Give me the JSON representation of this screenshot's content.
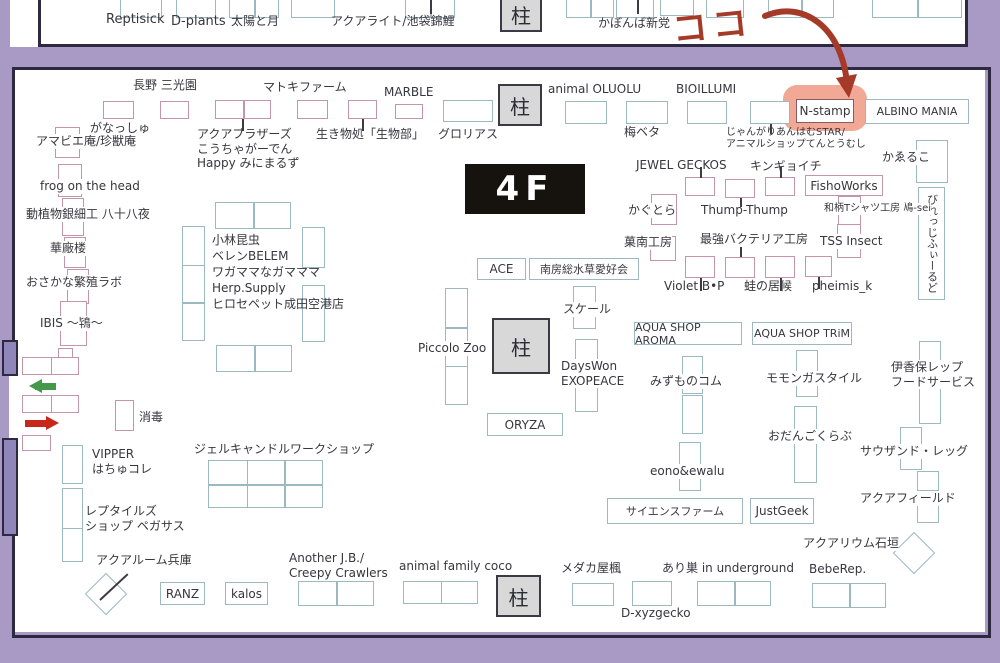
{
  "annotation": {
    "text": "ココ",
    "color": "#a63a28"
  },
  "floor": {
    "label": "4F"
  },
  "pillar_label": "柱",
  "colors": {
    "bg": "#a89ac5",
    "wall": "#9186b9",
    "border": "#2c2940",
    "pink": "#c494a8",
    "teal": "#9cb9c2",
    "nstamp_border": "#8a5a66",
    "highlight": "#ef9a82",
    "green_arrow": "#44984a",
    "red_arrow": "#c8271b",
    "pillar_fill": "#d8d8d8"
  },
  "top_strip": {
    "labels": [
      {
        "t": "Reptisick",
        "x": 96,
        "y": 12,
        "s": 13
      },
      {
        "t": "D-plants",
        "x": 161,
        "y": 14,
        "s": 13
      },
      {
        "t": "太陽と月",
        "x": 221,
        "y": 14
      },
      {
        "t": "アクアライト/池袋錦鯉",
        "x": 321,
        "y": 14
      },
      {
        "t": "かぼんば新党",
        "x": 588,
        "y": 16
      }
    ],
    "boxes": [
      {
        "x": 110,
        "y": -10,
        "w": 42,
        "h": 28
      },
      {
        "x": 166,
        "y": -10,
        "w": 40,
        "h": 28
      },
      {
        "x": 219,
        "y": -10,
        "w": 50,
        "h": 28,
        "n": 2
      },
      {
        "x": 281,
        "y": -10,
        "w": 44,
        "h": 28
      },
      {
        "x": 395,
        "y": -10,
        "w": 50,
        "h": 28,
        "n": 2
      },
      {
        "x": 556,
        "y": -10,
        "w": 48,
        "h": 28,
        "n": 2
      },
      {
        "x": 606,
        "y": -10,
        "w": 38,
        "h": 28
      },
      {
        "x": 650,
        "y": -8,
        "w": 34,
        "h": 24
      },
      {
        "x": 696,
        "y": -10,
        "w": 38,
        "h": 28
      },
      {
        "x": 758,
        "y": -10,
        "w": 66,
        "h": 28,
        "n": 2
      },
      {
        "x": 862,
        "y": -10,
        "w": 90,
        "h": 28,
        "n": 2
      }
    ],
    "ticks": [
      [
        420,
        0,
        14
      ],
      [
        627,
        0,
        14
      ]
    ],
    "pillar": {
      "x": 490,
      "y": -4,
      "w": 42,
      "h": 36
    }
  },
  "map": {
    "labels": [
      {
        "t": "長野 三光園",
        "x": 133,
        "y": 78
      },
      {
        "t": "マトキファーム",
        "x": 263,
        "y": 80
      },
      {
        "t": "MARBLE",
        "x": 384,
        "y": 85
      },
      {
        "t": "animal OLUOLU",
        "x": 548,
        "y": 82
      },
      {
        "t": "BIOILLUMI",
        "x": 676,
        "y": 82
      },
      {
        "t": "がなっしゅ",
        "x": 90,
        "y": 121
      },
      {
        "t": "アマビエ庵/珍獣庵",
        "x": 36,
        "y": 134,
        "bg": true
      },
      {
        "t": "アクアブラザーズ\nこうちゃがーでん\nHappy みにまるず",
        "x": 197,
        "y": 127
      },
      {
        "t": "生き物処「生物部」",
        "x": 316,
        "y": 127
      },
      {
        "t": "グロリアス",
        "x": 438,
        "y": 127
      },
      {
        "t": "梅ベタ",
        "x": 624,
        "y": 125
      },
      {
        "t": "じゃんがりあんはむSTAR/\nアニマルショップてんとうむし",
        "x": 726,
        "y": 127,
        "s": 10
      },
      {
        "t": "かゑるこ",
        "x": 882,
        "y": 150,
        "bg": true
      },
      {
        "t": "JEWEL GECKOS",
        "x": 636,
        "y": 158
      },
      {
        "t": "キンギョイチ",
        "x": 750,
        "y": 159
      },
      {
        "t": "かぐとら",
        "x": 628,
        "y": 203,
        "bg": true
      },
      {
        "t": "Thump-Thump",
        "x": 701,
        "y": 203
      },
      {
        "t": "和柄Tシャツ工房 鳰-sei",
        "x": 824,
        "y": 203,
        "s": 10,
        "bg": true
      },
      {
        "t": "菓南工房",
        "x": 624,
        "y": 235,
        "bg": true
      },
      {
        "t": "最強バクテリア工房",
        "x": 700,
        "y": 232
      },
      {
        "t": "TSS Insect",
        "x": 820,
        "y": 234,
        "bg": true
      },
      {
        "t": "frog on the head",
        "x": 40,
        "y": 179,
        "bg": true
      },
      {
        "t": "動植物銀細工 八十八夜",
        "x": 26,
        "y": 207,
        "bg": true
      },
      {
        "t": "華廠楼",
        "x": 50,
        "y": 241,
        "bg": true
      },
      {
        "t": "おさかな繁殖ラボ",
        "x": 26,
        "y": 275,
        "bg": true
      },
      {
        "t": "IBIS ～鴇～",
        "x": 40,
        "y": 316,
        "bg": true
      },
      {
        "t": "小林昆虫",
        "x": 212,
        "y": 233
      },
      {
        "t": "ベレンBELEM",
        "x": 212,
        "y": 249
      },
      {
        "t": "ワガママなガマママ",
        "x": 212,
        "y": 265
      },
      {
        "t": "Herp.Supply",
        "x": 212,
        "y": 281
      },
      {
        "t": "ヒロセペット成田空港店",
        "x": 212,
        "y": 297
      },
      {
        "t": "Violet B•P",
        "x": 664,
        "y": 279
      },
      {
        "t": "蛙の居候",
        "x": 744,
        "y": 279
      },
      {
        "t": "pheimis_k",
        "x": 812,
        "y": 279
      },
      {
        "t": "スケール",
        "x": 563,
        "y": 302,
        "bg": true
      },
      {
        "t": "Piccolo Zoo",
        "x": 418,
        "y": 341,
        "bg": true
      },
      {
        "t": "DaysWon\nEXOPEACE",
        "x": 561,
        "y": 359,
        "bg": true
      },
      {
        "t": "みずものコム",
        "x": 650,
        "y": 374,
        "bg": true
      },
      {
        "t": "モモンガスタイル",
        "x": 766,
        "y": 371,
        "bg": true
      },
      {
        "t": "伊香保レップ\nフードサービス",
        "x": 891,
        "y": 360,
        "bg": true
      },
      {
        "t": "おだんごくらぶ",
        "x": 768,
        "y": 429,
        "bg": true
      },
      {
        "t": "サウザンド・レッグ",
        "x": 860,
        "y": 444,
        "bg": true
      },
      {
        "t": "eono&ewalu",
        "x": 650,
        "y": 464,
        "bg": true
      },
      {
        "t": "アクアフィールド",
        "x": 860,
        "y": 491,
        "bg": true
      },
      {
        "t": "アクアリウム石垣",
        "x": 803,
        "y": 536,
        "bg": true
      },
      {
        "t": "消毒",
        "x": 139,
        "y": 410
      },
      {
        "t": "VIPPER\nはちゅコレ",
        "x": 92,
        "y": 447
      },
      {
        "t": "レプタイルズ\nショップ ペガサス",
        "x": 85,
        "y": 504
      },
      {
        "t": "アクアルーム兵庫",
        "x": 96,
        "y": 553
      },
      {
        "t": "ジェルキャンドルワークショップ",
        "x": 194,
        "y": 442
      },
      {
        "t": "Another J.B./\nCreepy Crawlers",
        "x": 289,
        "y": 551
      },
      {
        "t": "animal family coco",
        "x": 399,
        "y": 559
      },
      {
        "t": "メダカ屋楓",
        "x": 561,
        "y": 561
      },
      {
        "t": "あり巣 in underground",
        "x": 662,
        "y": 561
      },
      {
        "t": "BebeRep.",
        "x": 809,
        "y": 562
      },
      {
        "t": "D-xyzgecko",
        "x": 621,
        "y": 606
      }
    ],
    "boxes": [
      {
        "x": 103,
        "y": 101,
        "w": 31,
        "h": 18
      },
      {
        "x": 160,
        "y": 101,
        "w": 29,
        "h": 18
      },
      {
        "x": 215,
        "y": 100,
        "w": 56,
        "h": 19,
        "n": 2
      },
      {
        "x": 297,
        "y": 100,
        "w": 31,
        "h": 19
      },
      {
        "x": 348,
        "y": 100,
        "w": 29,
        "h": 19
      },
      {
        "x": 395,
        "y": 104,
        "w": 28,
        "h": 15
      },
      {
        "x": 55,
        "y": 127,
        "w": 25,
        "h": 31
      },
      {
        "x": 58,
        "y": 164,
        "w": 24,
        "h": 33
      },
      {
        "x": 62,
        "y": 198,
        "w": 22,
        "h": 38
      },
      {
        "x": 64,
        "y": 237,
        "w": 22,
        "h": 31
      },
      {
        "x": 67,
        "y": 269,
        "w": 22,
        "h": 35
      },
      {
        "x": 60,
        "y": 301,
        "w": 27,
        "h": 45
      },
      {
        "x": 58,
        "y": 348,
        "w": 15,
        "h": 14
      },
      {
        "x": 22,
        "y": 357,
        "w": 57,
        "h": 18,
        "n": 2
      },
      {
        "x": 22,
        "y": 395,
        "w": 57,
        "h": 18,
        "n": 2
      },
      {
        "x": 22,
        "y": 435,
        "w": 29,
        "h": 16
      },
      {
        "x": 115,
        "y": 400,
        "w": 19,
        "h": 31
      },
      {
        "x": 651,
        "y": 194,
        "w": 26,
        "h": 31
      },
      {
        "x": 650,
        "y": 236,
        "w": 26,
        "h": 25
      },
      {
        "x": 838,
        "y": 196,
        "w": 23,
        "h": 29
      },
      {
        "x": 837,
        "y": 224,
        "w": 24,
        "h": 34
      },
      {
        "x": 685,
        "y": 177,
        "w": 30,
        "h": 19
      },
      {
        "x": 725,
        "y": 179,
        "w": 30,
        "h": 19
      },
      {
        "x": 765,
        "y": 177,
        "w": 30,
        "h": 19
      },
      {
        "x": 685,
        "y": 256,
        "w": 30,
        "h": 22
      },
      {
        "x": 725,
        "y": 257,
        "w": 30,
        "h": 21
      },
      {
        "x": 765,
        "y": 256,
        "w": 30,
        "h": 22
      },
      {
        "x": 805,
        "y": 256,
        "w": 27,
        "h": 21
      },
      {
        "x": 805,
        "y": 175,
        "w": 78,
        "h": 21,
        "txt": "FishoWorks"
      },
      {
        "x": 796,
        "y": 99,
        "w": 58,
        "h": 24,
        "c": "n",
        "txt": "N-stamp"
      },
      {
        "x": 443,
        "y": 100,
        "w": 50,
        "h": 22,
        "c": "t"
      },
      {
        "x": 565,
        "y": 101,
        "w": 42,
        "h": 23,
        "c": "t"
      },
      {
        "x": 626,
        "y": 101,
        "w": 42,
        "h": 23,
        "c": "t"
      },
      {
        "x": 687,
        "y": 101,
        "w": 40,
        "h": 23,
        "c": "t"
      },
      {
        "x": 750,
        "y": 101,
        "w": 40,
        "h": 23,
        "c": "t"
      },
      {
        "x": 865,
        "y": 99,
        "w": 104,
        "h": 25,
        "c": "t",
        "txt": "ALBINO MANIA",
        "s": 11
      },
      {
        "x": 916,
        "y": 140,
        "w": 32,
        "h": 43,
        "c": "t"
      },
      {
        "x": 918,
        "y": 187,
        "w": 27,
        "h": 113,
        "c": "t",
        "vt": "びれっじふぃーるど"
      },
      {
        "x": 215,
        "y": 202,
        "w": 76,
        "h": 27,
        "c": "t",
        "n": 2
      },
      {
        "x": 182,
        "y": 226,
        "w": 23,
        "h": 115,
        "c": "t",
        "n": 3,
        "d": "v"
      },
      {
        "x": 302,
        "y": 227,
        "w": 23,
        "h": 41,
        "c": "t"
      },
      {
        "x": 302,
        "y": 285,
        "w": 23,
        "h": 57,
        "c": "t"
      },
      {
        "x": 216,
        "y": 345,
        "w": 76,
        "h": 27,
        "c": "t",
        "n": 2
      },
      {
        "x": 477,
        "y": 258,
        "w": 49,
        "h": 22,
        "c": "t",
        "txt": "ACE"
      },
      {
        "x": 529,
        "y": 258,
        "w": 110,
        "h": 22,
        "c": "t",
        "txt": "南房総水草愛好会",
        "s": 11
      },
      {
        "x": 573,
        "y": 286,
        "w": 23,
        "h": 43,
        "c": "t"
      },
      {
        "x": 575,
        "y": 339,
        "w": 23,
        "h": 73,
        "c": "t"
      },
      {
        "x": 445,
        "y": 288,
        "w": 23,
        "h": 117,
        "c": "t",
        "n": 3,
        "d": "v"
      },
      {
        "x": 487,
        "y": 413,
        "w": 76,
        "h": 23,
        "c": "t",
        "txt": "ORYZA"
      },
      {
        "x": 634,
        "y": 322,
        "w": 108,
        "h": 23,
        "c": "t",
        "txt": "AQUA SHOP AROMA",
        "s": 11
      },
      {
        "x": 752,
        "y": 322,
        "w": 100,
        "h": 23,
        "c": "t",
        "txt": "AQUA SHOP TRiM",
        "s": 11
      },
      {
        "x": 682,
        "y": 356,
        "w": 21,
        "h": 38,
        "c": "t"
      },
      {
        "x": 682,
        "y": 395,
        "w": 21,
        "h": 39,
        "c": "t"
      },
      {
        "x": 796,
        "y": 350,
        "w": 22,
        "h": 47,
        "c": "t"
      },
      {
        "x": 919,
        "y": 341,
        "w": 22,
        "h": 83,
        "c": "t"
      },
      {
        "x": 794,
        "y": 406,
        "w": 23,
        "h": 77,
        "c": "t"
      },
      {
        "x": 900,
        "y": 427,
        "w": 22,
        "h": 43,
        "c": "t"
      },
      {
        "x": 679,
        "y": 442,
        "w": 22,
        "h": 49,
        "c": "t"
      },
      {
        "x": 917,
        "y": 471,
        "w": 22,
        "h": 20,
        "c": "t"
      },
      {
        "x": 917,
        "y": 504,
        "w": 22,
        "h": 19,
        "c": "t"
      },
      {
        "x": 62,
        "y": 445,
        "w": 21,
        "h": 39,
        "c": "t"
      },
      {
        "x": 62,
        "y": 488,
        "w": 21,
        "h": 41,
        "c": "t"
      },
      {
        "x": 62,
        "y": 528,
        "w": 21,
        "h": 34,
        "c": "t"
      },
      {
        "x": 208,
        "y": 460,
        "w": 115,
        "h": 48,
        "c": "t",
        "grid": [
          3,
          2
        ]
      },
      {
        "x": 607,
        "y": 498,
        "w": 136,
        "h": 26,
        "c": "t",
        "txt": "サイエンスファーム",
        "s": 11
      },
      {
        "x": 750,
        "y": 498,
        "w": 64,
        "h": 26,
        "c": "t",
        "txt": "JustGeek"
      },
      {
        "x": 160,
        "y": 582,
        "w": 45,
        "h": 23,
        "c": "t",
        "txt": "RANZ"
      },
      {
        "x": 225,
        "y": 582,
        "w": 43,
        "h": 23,
        "c": "t",
        "txt": "kalos"
      },
      {
        "x": 298,
        "y": 581,
        "w": 76,
        "h": 25,
        "c": "t",
        "n": 2
      },
      {
        "x": 403,
        "y": 581,
        "w": 75,
        "h": 23,
        "c": "t",
        "n": 2
      },
      {
        "x": 572,
        "y": 583,
        "w": 42,
        "h": 23,
        "c": "t"
      },
      {
        "x": 632,
        "y": 581,
        "w": 40,
        "h": 25,
        "c": "t"
      },
      {
        "x": 697,
        "y": 581,
        "w": 74,
        "h": 25,
        "c": "t",
        "n": 2
      },
      {
        "x": 812,
        "y": 583,
        "w": 74,
        "h": 25,
        "c": "t",
        "n": 2
      },
      {
        "x": 899,
        "y": 538,
        "w": 30,
        "h": 30,
        "c": "t",
        "rot": 45
      },
      {
        "x": 91,
        "y": 579,
        "w": 30,
        "h": 30,
        "c": "t",
        "rot": 45
      }
    ],
    "pillars": [
      {
        "x": 498,
        "y": 84,
        "w": 44,
        "h": 42
      },
      {
        "x": 492,
        "y": 318,
        "w": 58,
        "h": 56
      },
      {
        "x": 496,
        "y": 575,
        "w": 45,
        "h": 42
      }
    ],
    "ticks": [
      [
        242,
        119,
        12
      ],
      [
        362,
        119,
        12
      ],
      [
        770,
        124,
        10
      ],
      [
        700,
        167,
        11
      ],
      [
        780,
        167,
        11
      ],
      [
        740,
        198,
        9
      ],
      [
        740,
        247,
        10
      ],
      [
        700,
        278,
        13
      ],
      [
        780,
        278,
        13
      ],
      [
        818,
        277,
        12
      ]
    ],
    "walls": [
      {
        "x": 2,
        "y": 340,
        "w": 16,
        "h": 36
      },
      {
        "x": 2,
        "y": 438,
        "w": 16,
        "h": 98
      }
    ],
    "highlight": {
      "x": 783,
      "y": 85,
      "w": 84,
      "h": 46
    }
  }
}
